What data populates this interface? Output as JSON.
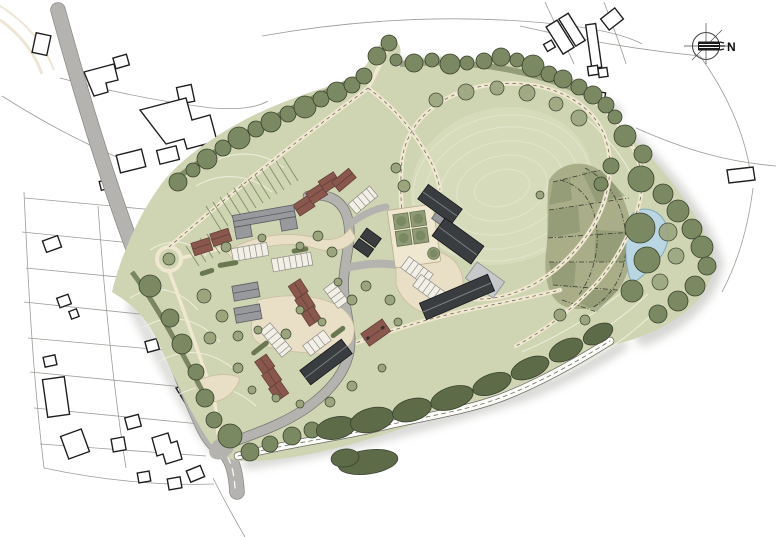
{
  "canvas": {
    "width": 776,
    "height": 537
  },
  "compass": {
    "label": "N",
    "icon": "north-arrow-compass"
  },
  "colors": {
    "paper": "#ffffff",
    "ink": "#1f1f1f",
    "plotLine": "#9b9b96",
    "roadGray": "#b4b3af",
    "roadEdge": "#8a8985",
    "estateRoadEdge": "#77766f",
    "centerline": "#ffffff",
    "siteGreen": "#cfd4b2",
    "meadowGreen": "#dadec2",
    "contour": "#edefdc",
    "pathCream": "#efe7cf",
    "pathDash": "#6e6e60",
    "sharedSurface": "#e9dfc6",
    "hedgeGreen": "#6a7852",
    "scrubGreen": "#5d6b49",
    "boundaryTree": "#7a8961",
    "canopyLight": "#9aa57e",
    "treeOutline": "#3a4230",
    "orchardGreen": "#8f9b74",
    "allotmentBase": "#a9ae88",
    "allotmentShade": "#808c66",
    "allotmentLine": "#3c3c34",
    "pondBlue": "#b9d6e2",
    "pondEdge": "#82aabb",
    "roofDark": "#3a3d40",
    "roofDarkEdge": "#131416",
    "roofRidgeLight": "#7b7e82",
    "roofGray": "#97999c",
    "roofGrayEdge": "#5a5d60",
    "roofLight": "#c6c8ca",
    "roofRed": "#8a574d",
    "roofRedEdge": "#63403a",
    "parkingFill": "#f2efe7",
    "parkingLine": "#8f8d85",
    "shadow": "#a3a39e",
    "streamEdge": "#6b6b64",
    "streamFill": "#fcfcf9",
    "compassInk": "#4a4a4a",
    "arrowBlack": "#191919"
  }
}
